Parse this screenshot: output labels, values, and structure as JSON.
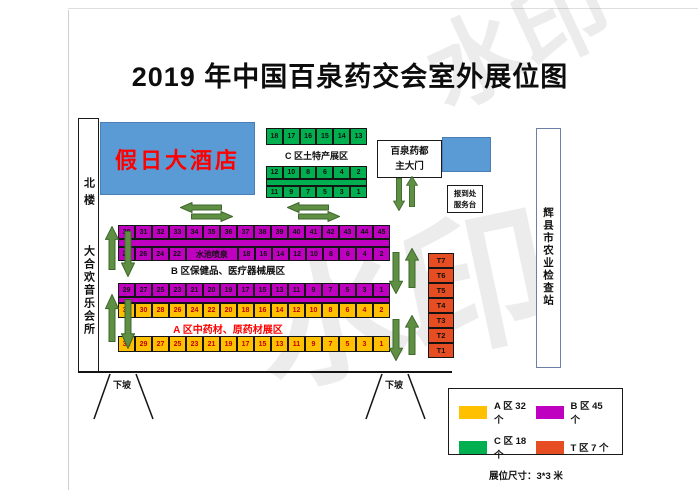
{
  "page": {
    "title": "2019 年中国百泉药交会室外展位图",
    "watermark": "水印"
  },
  "colors": {
    "blue": "#5B9BD5",
    "green": "#00B050",
    "purple": "#C000C0",
    "yellow": "#FFC000",
    "red": "#E64D22",
    "arrow": "#5E8F43",
    "arrow_dark": "#3F672C",
    "label_red": "#FF0000",
    "booth_num_red": "#C00000"
  },
  "buildings": {
    "north_building": "北楼",
    "music_club": "大合欢音乐会所",
    "hotel": "假日大酒店",
    "station": "辉县市农业检查站"
  },
  "gate": {
    "line1": "百泉药都",
    "line2": "主大门"
  },
  "service_desk": {
    "line1": "报到处",
    "line2": "服务台"
  },
  "zone_c": {
    "label": "C 区土特产展区",
    "row_top": [
      "18",
      "17",
      "16",
      "15",
      "14",
      "13"
    ],
    "row_mid": [
      "12",
      "10",
      "8",
      "6",
      "4",
      "2"
    ],
    "row_bottom": [
      "11",
      "9",
      "7",
      "5",
      "3",
      "1"
    ]
  },
  "zone_b": {
    "label": "B 区保健品、医疗器械展区",
    "row1": [
      "30",
      "31",
      "32",
      "33",
      "34",
      "35",
      "36",
      "37",
      "38",
      "39",
      "40",
      "41",
      "42",
      "43",
      "44",
      "45"
    ],
    "row2_left": [
      "28",
      "26",
      "24",
      "22"
    ],
    "fountain_label": "水池喷泉",
    "row2_right": [
      "18",
      "16",
      "14",
      "12",
      "10",
      "8",
      "6",
      "4",
      "2"
    ],
    "row3": [
      "29",
      "27",
      "25",
      "23",
      "21",
      "20",
      "19",
      "17",
      "15",
      "13",
      "11",
      "9",
      "7",
      "5",
      "3",
      "1"
    ]
  },
  "zone_a": {
    "label": "A 区中药材、原药材展区",
    "row_even": [
      "32",
      "30",
      "28",
      "26",
      "24",
      "22",
      "20",
      "18",
      "16",
      "14",
      "12",
      "10",
      "8",
      "6",
      "4",
      "2"
    ],
    "row_odd": [
      "31",
      "29",
      "27",
      "25",
      "23",
      "21",
      "19",
      "17",
      "15",
      "13",
      "11",
      "9",
      "7",
      "5",
      "3",
      "1"
    ]
  },
  "zone_t": {
    "booths": [
      "T7",
      "T6",
      "T5",
      "T4",
      "T3",
      "T2",
      "T1"
    ]
  },
  "ramp_label": "下坡",
  "legend": {
    "items": [
      {
        "label": "A 区 32 个",
        "color": "#FFC000"
      },
      {
        "label": "B 区 45 个",
        "color": "#C000C0"
      },
      {
        "label": "C 区 18 个",
        "color": "#00B050"
      },
      {
        "label": "T 区 7 个",
        "color": "#E64D22"
      }
    ],
    "size_note": "展位尺寸：3*3 米"
  }
}
